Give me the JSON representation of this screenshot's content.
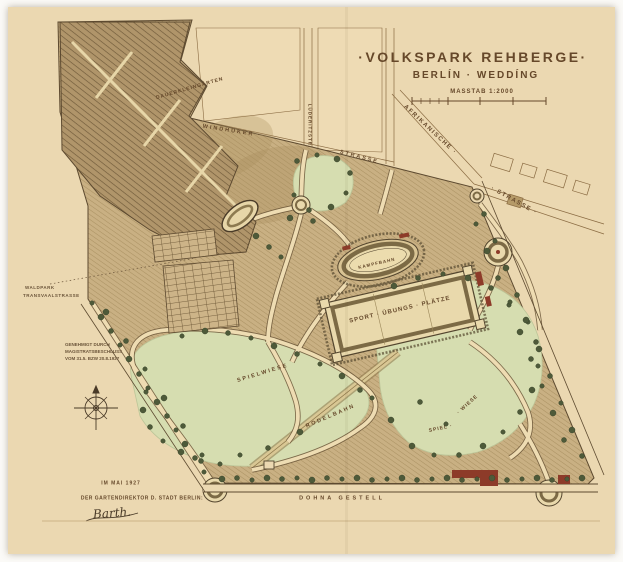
{
  "map": {
    "title": "·VOLKSPARK REHBERGE·",
    "subtitle": "BERLÍN · WEDDÍNG",
    "scale_label": "MASSTAB 1:2000",
    "streets": {
      "windhuker": "WINDHUKER ·",
      "strasse_north": "STRASSE",
      "luederitz": "LÜDERITZSTR.",
      "afrikanische": "AFRIKANISCHE ·",
      "strasse_east": "· STRASSE ·",
      "dohnagestell": "DOHNA GESTELL"
    },
    "areas": {
      "dauerkleingaerten": "DAUERKLEINGÄRTEN",
      "kampfbahn": "KAMPFBAHN",
      "sportplaetze": "SPORT · ÜBUNGS · PLÄTZE",
      "spielwiese": "SPIELWIESE",
      "rodelbahn": "RODELBAHN",
      "spiel": "SPIEL ·",
      "wiese": "· WIESE"
    },
    "notes": {
      "boundary_line1": "WALDPARK",
      "boundary_line2": "TRANSVAALSTRASSE",
      "approval_line1": "GENEHMIGT DURCH",
      "approval_line2": "MAGISTRATSBESCHLUSS",
      "approval_line3": "VOM 31.5. BZW 20.8.1927"
    },
    "signature": {
      "date": "IM MAI 1927",
      "title_line": "DER GARTENDIREKTOR D. STADT BERLIN:",
      "name": "Barth."
    },
    "colors": {
      "paper": "#ebd8b1",
      "ink": "#5d4a30",
      "title_ink": "#66482a",
      "meadow": "#d6ddb0",
      "woodland": "#c9b083",
      "allotment": "#b0956a",
      "tree": "#4e5a39",
      "building_red": "#8d3b29",
      "path_cream": "#eedcb2"
    }
  }
}
